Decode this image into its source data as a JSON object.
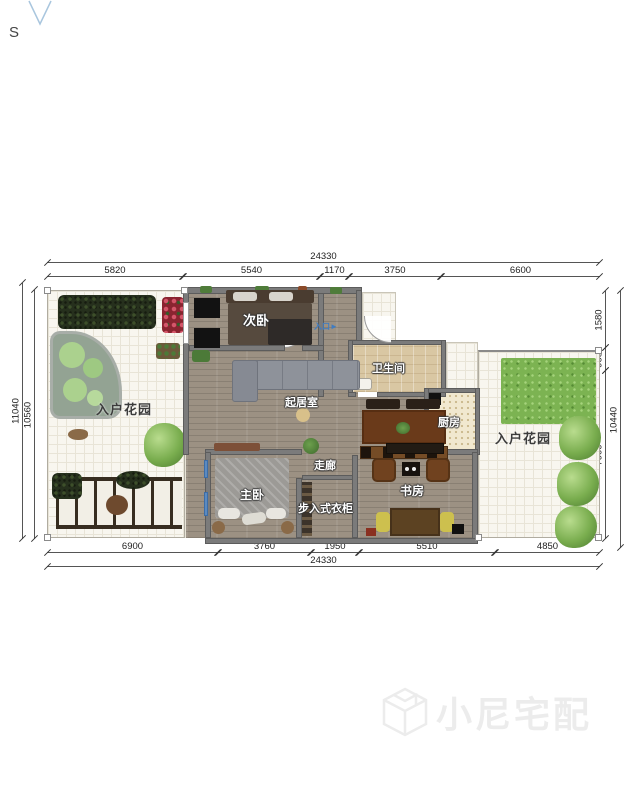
{
  "compass": {
    "south_label": "S"
  },
  "dimensions": {
    "top": {
      "total": "24330",
      "segments": [
        "5820",
        "5540",
        "1170",
        "3750",
        "6600"
      ]
    },
    "bottom": {
      "total": "24330",
      "segments": [
        "6900",
        "3760",
        "1950",
        "5510",
        "4850"
      ]
    },
    "left": {
      "outer": "11040",
      "inner": "10560"
    },
    "right": {
      "outer": "10440",
      "segments": [
        "1580",
        "960",
        "7900"
      ]
    }
  },
  "rooms": {
    "secondary_bedroom": "次卧",
    "bathroom": "卫生间",
    "living_room": "起居室",
    "kitchen": "厨房",
    "corridor": "走廊",
    "master_bedroom": "主卧",
    "walk_in_closet": "步入式衣柜",
    "study": "书房",
    "garden_left": "入户花园",
    "garden_right": "入户花园"
  },
  "entrance": {
    "label": "入口",
    "arrow": "►"
  },
  "watermark": {
    "brand": "小尼宅配"
  },
  "colors": {
    "wall": "#7b7b7b",
    "entrance_blue": "#3f7cc2",
    "lawn_green": "#7cb352",
    "watermark_gray": "#ececec"
  }
}
